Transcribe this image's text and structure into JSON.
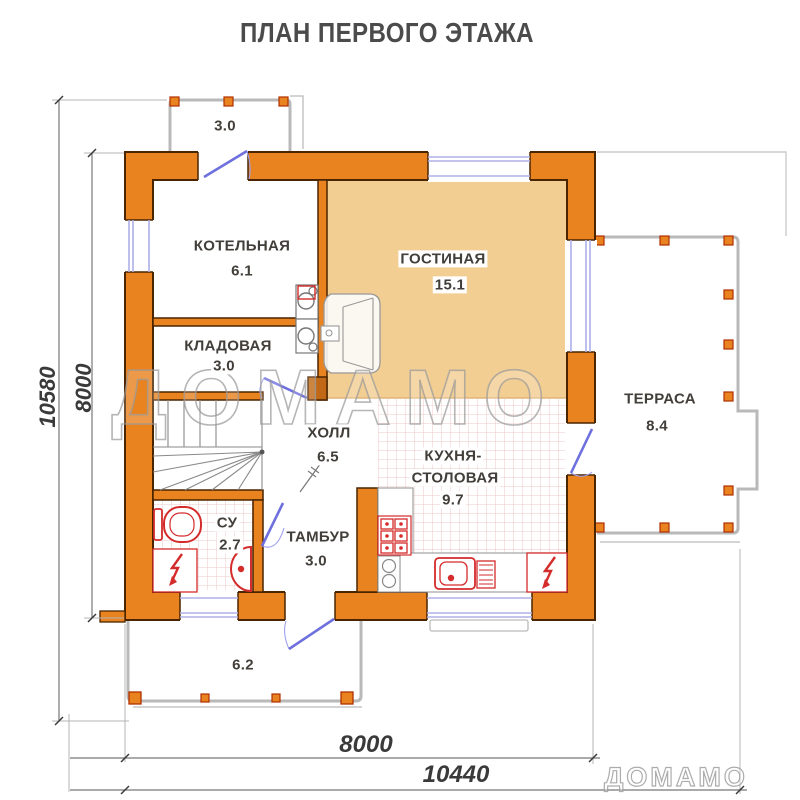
{
  "title": "ПЛАН ПЕРВОГО ЭТАЖА",
  "watermark": {
    "large": "ДОМАМО",
    "small": "ДОМАМО"
  },
  "rooms": {
    "boiler": {
      "name": "КОТЕЛЬНАЯ",
      "area": "6.1"
    },
    "living": {
      "name": "ГОСТИНАЯ",
      "area": "15.1"
    },
    "storage": {
      "name": "КЛАДОВАЯ",
      "area": "3.0"
    },
    "hall": {
      "name": "ХОЛЛ",
      "area": "6.5"
    },
    "kitchen": {
      "name_line1": "КУХНЯ-",
      "name_line2": "СТОЛОВАЯ",
      "area": "9.7"
    },
    "bathroom": {
      "name": "СУ",
      "area": "2.7"
    },
    "vestibule": {
      "name": "ТАМБУР",
      "area": "3.0"
    },
    "terrace": {
      "name": "ТЕРРАСА",
      "area": "8.4"
    },
    "porch_top": {
      "area": "3.0"
    },
    "porch_bottom": {
      "area": "6.2"
    }
  },
  "dimensions": {
    "left_outer": "10580",
    "left_inner": "8000",
    "bottom_inner": "8000",
    "bottom_outer": "10440"
  },
  "colors": {
    "wall_fill": "#E8831F",
    "wall_outline": "#4A2500",
    "living_fill": "#F3CE93",
    "door_blue": "#6E70DE",
    "window_lavender": "#AFAFE8",
    "fixture_red": "#D42B2B",
    "porch_gray": "#B9B9B9",
    "dimension_gray": "#777777"
  }
}
